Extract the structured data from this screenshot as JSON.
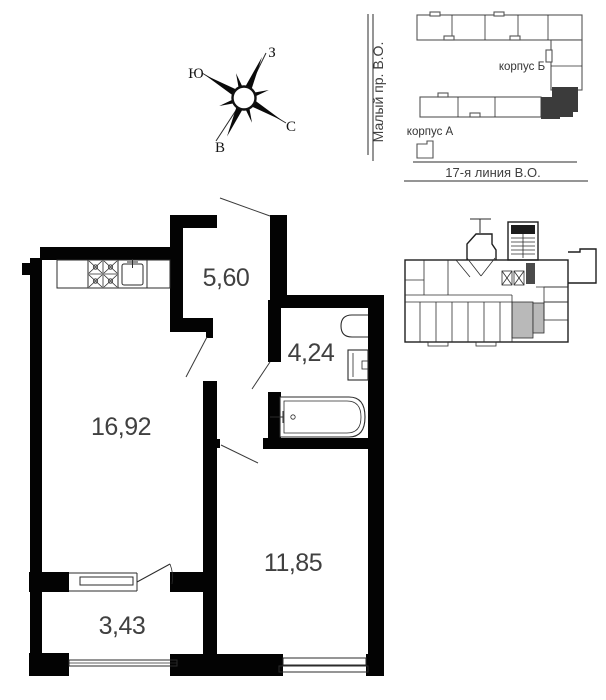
{
  "floor_plan": {
    "rooms": [
      {
        "name": "hallway",
        "area": "5,60"
      },
      {
        "name": "bathroom",
        "area": "4,24"
      },
      {
        "name": "living-room",
        "area": "16,92"
      },
      {
        "name": "bedroom",
        "area": "11,85"
      },
      {
        "name": "balcony",
        "area": "3,43"
      }
    ],
    "wall_color": "#030303",
    "label_color": "#404040"
  },
  "compass": {
    "west": "З",
    "south": "Ю",
    "north": "С",
    "east": "В"
  },
  "site_map": {
    "street_vertical": "Малый пр. В.О.",
    "street_horizontal": "17-я линия В.О.",
    "building_b": "корпус Б",
    "building_a": "корпус А",
    "highlight_color": "#3b3b3b"
  },
  "key_plan": {
    "highlight_color": "#b9b9b9"
  }
}
